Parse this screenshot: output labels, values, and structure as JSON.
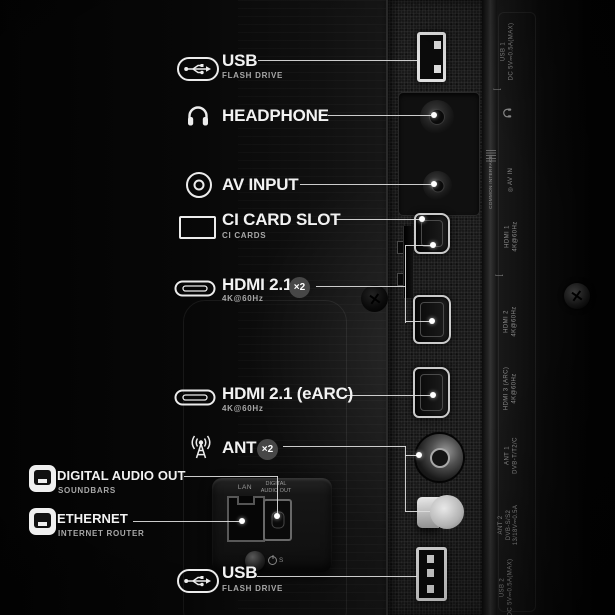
{
  "colors": {
    "background": "#0a0a0a",
    "label_text": "#f2f2f2",
    "sub_text": "#a8a8a8",
    "callout_line": "#dcdcdc",
    "badge_bg": "#474747",
    "panel_print_text": "#8b8b8b"
  },
  "callouts": [
    {
      "id": "usb-top",
      "title": "USB",
      "subtitle": "FLASH DRIVE",
      "icon": "usb-icon"
    },
    {
      "id": "headphone",
      "title": "HEADPHONE",
      "icon": "headphone-icon"
    },
    {
      "id": "av-input",
      "title": "AV INPUT",
      "icon": "av-input-icon"
    },
    {
      "id": "ci-card-slot",
      "title": "CI CARD SLOT",
      "subtitle": "CI CARDS",
      "icon": "ci-card-icon"
    },
    {
      "id": "hdmi-21",
      "title": "HDMI 2.1",
      "badge": "×2",
      "subtitle": "4K@60Hz",
      "icon": "hdmi-icon"
    },
    {
      "id": "hdmi-earc",
      "title": "HDMI 2.1 (eARC)",
      "subtitle": "4K@60Hz",
      "icon": "hdmi-icon"
    },
    {
      "id": "ant",
      "title": "ANT",
      "badge": "×2",
      "icon": "antenna-icon"
    },
    {
      "id": "digital-audio-out",
      "title": "DIGITAL AUDIO OUT",
      "subtitle": "SOUNDBARS",
      "icon": "audio-out-icon"
    },
    {
      "id": "ethernet",
      "title": "ETHERNET",
      "subtitle": "INTERNET ROUTER",
      "icon": "ethernet-icon"
    },
    {
      "id": "usb-bottom",
      "title": "USB",
      "subtitle": "FLASH DRIVE",
      "icon": "usb-icon"
    }
  ],
  "panel_prints": {
    "usb1": {
      "l1": "USB 1",
      "l2": "DC 5V⎓0.5A(MAX)"
    },
    "common_interface": "COMMON INTERFACE",
    "av_in": "AV IN",
    "hdmi1": {
      "l1": "HDMI 1",
      "l2": "4K@60Hz"
    },
    "hdmi2": {
      "l1": "HDMI 2",
      "l2": "4K@60Hz"
    },
    "hdmi3": {
      "l1": "HDMI 3 (ARC)",
      "l2": "4K@60Hz"
    },
    "ant1": {
      "l1": "ANT 1",
      "l2": "DVB-T/T2/C"
    },
    "ant2": {
      "l1": "ANT 2",
      "l2": "DVB-S/S2",
      "l3": "13/18V⎓0.5A"
    },
    "usb2": {
      "l1": "USB 2",
      "l2": "DC 5V⎓0.5A(MAX)"
    },
    "lan": "LAN",
    "digital_audio_out": "DIGITAL AUDIO OUT",
    "standby": "S"
  }
}
